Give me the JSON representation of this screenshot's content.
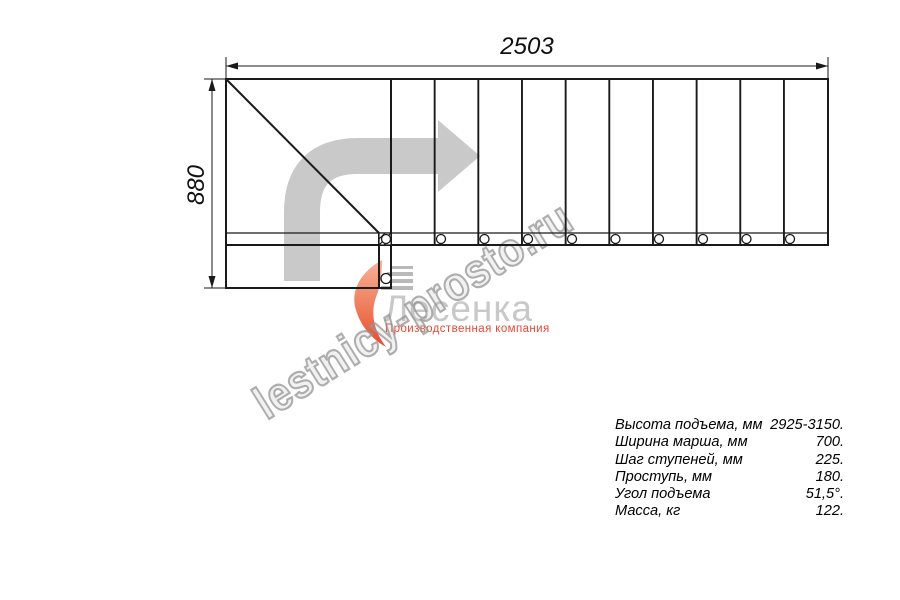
{
  "dimensions": {
    "width_mm": "2503",
    "height_mm": "880"
  },
  "specs": {
    "rows": [
      {
        "label": "Высота подъема, мм",
        "value": "2925-3150."
      },
      {
        "label": "Ширина марша, мм",
        "value": "700."
      },
      {
        "label": "Шаг ступеней, мм",
        "value": "225."
      },
      {
        "label": "Проступь, мм",
        "value": "180."
      },
      {
        "label": "Угол подъема",
        "value": "51,5°."
      },
      {
        "label": "Масса, кг",
        "value": "122."
      }
    ]
  },
  "watermark": {
    "text": "lestnicy-prosto.ru"
  },
  "logo": {
    "name": "Лесенка",
    "tagline": "Производственная компания"
  },
  "plan_summary": {
    "overall_length_mm": 2503,
    "overall_depth_mm": 880,
    "tread_count": 10
  },
  "colors": {
    "line": "#1a1a1a",
    "arrow": "#c9c9c9",
    "logo_gray": "#c8c8c8",
    "logo_red": "#e24a38",
    "watermark_gray": "#949494"
  },
  "drawing": {
    "outline": {
      "left": 226,
      "top": 79,
      "right": 828,
      "band_y": 233,
      "bottom": 245
    },
    "landing": {
      "left": 226,
      "top": 245,
      "right": 391,
      "bottom": 288
    },
    "newel_x": 379,
    "treads": {
      "x0": 391,
      "count": 10,
      "dx": 43.66
    },
    "holes": {
      "y": 239,
      "r": 4.5,
      "xs": [
        386,
        441,
        484.5,
        528,
        572,
        615.5,
        659,
        703,
        746.5,
        790
      ]
    },
    "landing_hole": {
      "x": 386,
      "y": 278.5,
      "r": 5
    },
    "dim_top": {
      "y": 66,
      "ext_top": 57
    },
    "dim_left": {
      "x": 212,
      "ext_left": 204
    },
    "arrow": {
      "shaft": "M302 281 L302 212 Q302 156 358 156 L438 156",
      "head": "438,120 438,192 480,156",
      "width": 36
    }
  }
}
